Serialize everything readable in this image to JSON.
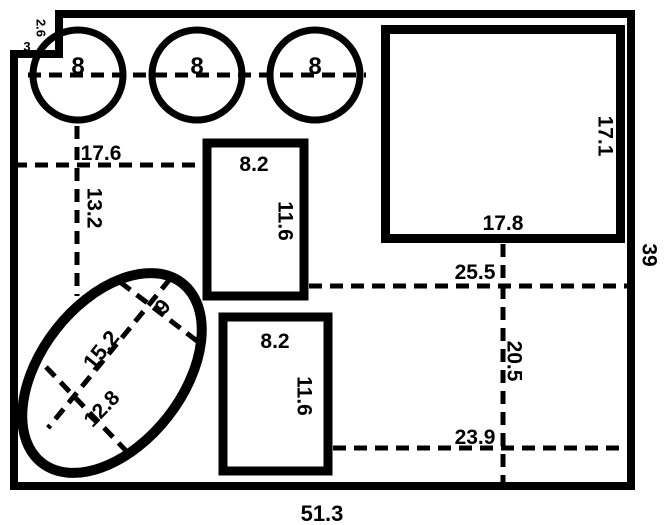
{
  "diagram": {
    "background": "#ffffff",
    "line_color": "#000000",
    "outer": {
      "total_width_label": "51.3",
      "total_height_label": "39",
      "notch_height_label": "2.6",
      "notch_width_label": "3"
    },
    "circles": {
      "labels": [
        "8",
        "8",
        "8"
      ]
    },
    "rect_top": {
      "width_label": "8.2",
      "height_label": "11.6"
    },
    "rect_bottom": {
      "width_label": "8.2",
      "height_label": "11.6"
    },
    "big_rect": {
      "height_label": "17.1",
      "width_label": "17.8"
    },
    "dims": {
      "d17_6": "17.6",
      "d13_2": "13.2",
      "d25_5": "25.5",
      "d20_5": "20.5",
      "d23_9": "23.9"
    },
    "oval": {
      "major_label": "15.2",
      "cross_small_label": "9",
      "cross_large_label": "12.8"
    }
  }
}
